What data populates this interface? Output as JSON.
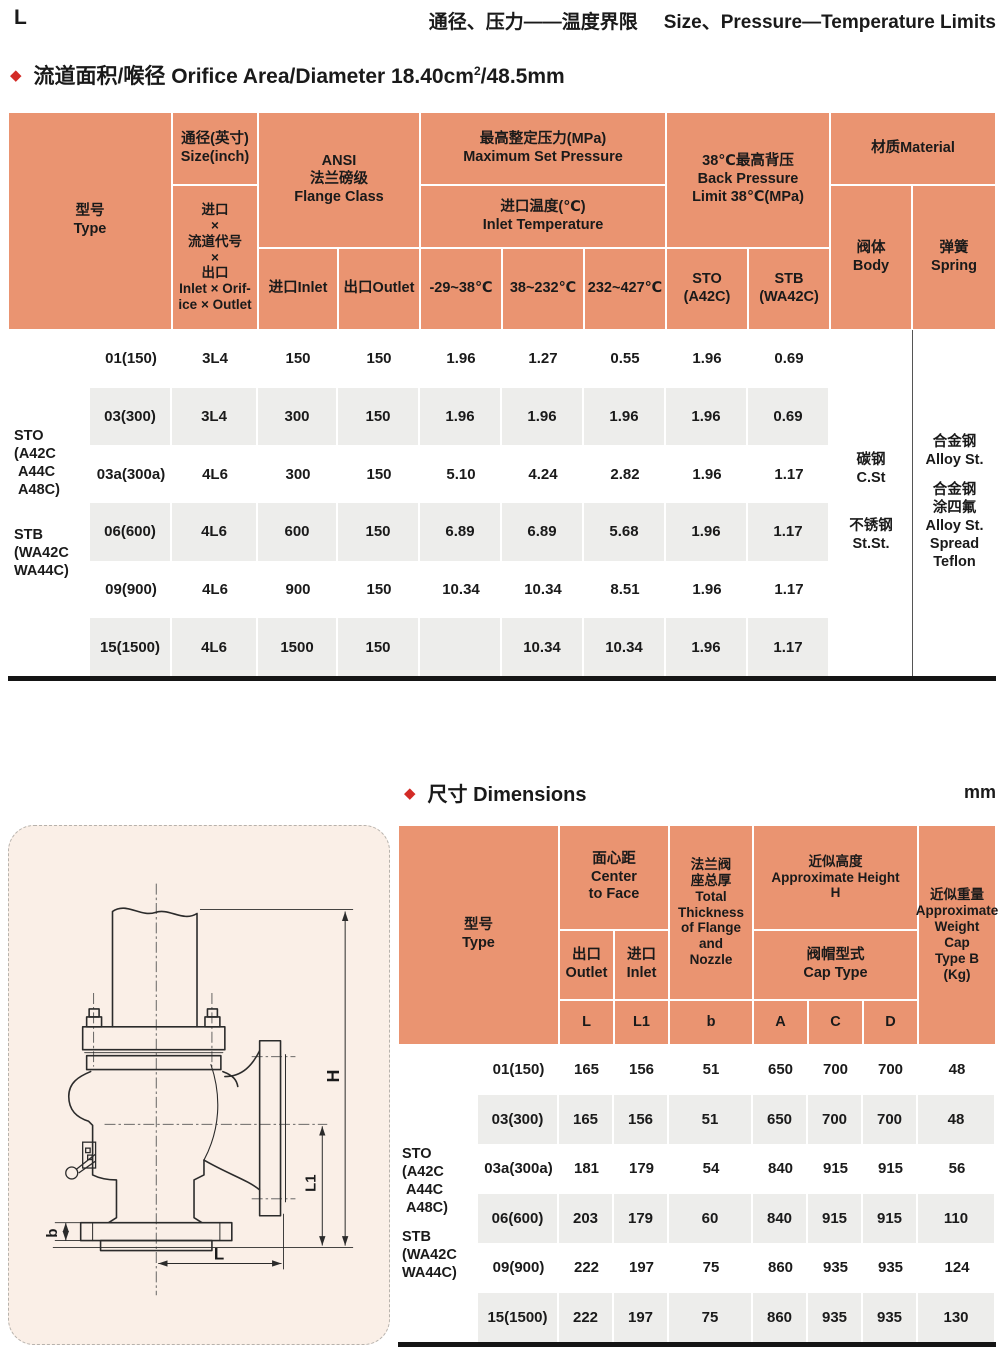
{
  "page": {
    "corner_letter": "L",
    "title_zh": "通径、压力——温度界限",
    "title_en": "Size、Pressure—Temperature Limits",
    "accent_red": "#d32b26",
    "header_orange": "#ea9471",
    "band_gray": "#ededeb"
  },
  "orifice": {
    "bullet": "◆",
    "text": "流道面积/喉径 Orifice Area/Diameter 18.40cm",
    "sup": "2",
    "suffix": "/48.5mm"
  },
  "pt_table": {
    "header": {
      "type": "型号\nType",
      "size": "通径(英寸)\nSize(inch)",
      "inlet_orifice_outlet": "进口\n×\n流道代号\n×\n出口\nInlet × Orif-\nice × Outlet",
      "ansi": "ANSI\n法兰磅级\nFlange Class",
      "inlet": "进口Inlet",
      "outlet": "出口Outlet",
      "max_set_pressure": "最高整定压力(MPa)\nMaximum Set Pressure",
      "inlet_temperature": "进口温度(℃)\nInlet Temperature",
      "temp1": "-29~38℃",
      "temp2": "38~232℃",
      "temp3": "232~427℃",
      "back_pressure": "38℃最高背压\nBack Pressure\nLimit 38℃(MPa)",
      "sto": "STO\n(A42C)",
      "stb": "STB\n(WA42C)",
      "material": "材质Material",
      "body": "阀体\nBody",
      "spring": "弹簧\nSpring"
    },
    "group_sto": "STO\n(A42C\n A44C\n A48C)",
    "group_stb": "STB\n(WA42C\nWA44C)",
    "body_carbon": "碳钢\nC.St",
    "body_stainless": "不锈钢\nSt.St.",
    "spring_alloy": "合金钢\nAlloy St.",
    "spring_teflon": "合金钢\n涂四氟\nAlloy St.\nSpread\nTeflon",
    "rows": [
      [
        "01(150)",
        "3L4",
        "150",
        "150",
        "1.96",
        "1.27",
        "0.55",
        "1.96",
        "0.69"
      ],
      [
        "03(300)",
        "3L4",
        "300",
        "150",
        "1.96",
        "1.96",
        "1.96",
        "1.96",
        "0.69"
      ],
      [
        "03a(300a)",
        "4L6",
        "300",
        "150",
        "5.10",
        "4.24",
        "2.82",
        "1.96",
        "1.17"
      ],
      [
        "06(600)",
        "4L6",
        "600",
        "150",
        "6.89",
        "6.89",
        "5.68",
        "1.96",
        "1.17"
      ],
      [
        "09(900)",
        "4L6",
        "900",
        "150",
        "10.34",
        "10.34",
        "8.51",
        "1.96",
        "1.17"
      ],
      [
        "15(1500)",
        "4L6",
        "1500",
        "150",
        "",
        "10.34",
        "10.34",
        "1.96",
        "1.17"
      ]
    ]
  },
  "dims": {
    "bullet": "◆",
    "title": "尺寸 Dimensions",
    "unit": "mm",
    "header": {
      "type": "型号\nType",
      "center_to_face": "面心距\nCenter\nto Face",
      "outlet": "出口\nOutlet",
      "inlet": "进口\nInlet",
      "thickness": "法兰阀\n座总厚\nTotal\nThickness\nof Flange\nand\nNozzle",
      "approx_height": "近似高度\nApproximate Height\nH",
      "cap_type": "阀帽型式\nCap Type",
      "weight": "近似重量\nApproximate\nWeight\nCap\nType B\n(Kg)"
    },
    "letters": [
      "L",
      "L1",
      "b",
      "A",
      "C",
      "D"
    ],
    "group_sto": "STO\n(A42C\n A44C\n A48C)",
    "group_stb": "STB\n(WA42C\nWA44C)",
    "rows": [
      [
        "01(150)",
        "165",
        "156",
        "51",
        "650",
        "700",
        "700",
        "48"
      ],
      [
        "03(300)",
        "165",
        "156",
        "51",
        "650",
        "700",
        "700",
        "48"
      ],
      [
        "03a(300a)",
        "181",
        "179",
        "54",
        "840",
        "915",
        "915",
        "56"
      ],
      [
        "06(600)",
        "203",
        "179",
        "60",
        "840",
        "915",
        "915",
        "110"
      ],
      [
        "09(900)",
        "222",
        "197",
        "75",
        "860",
        "935",
        "935",
        "124"
      ],
      [
        "15(1500)",
        "222",
        "197",
        "75",
        "860",
        "935",
        "935",
        "130"
      ]
    ]
  },
  "drawing": {
    "labels": {
      "h": "H",
      "l1": "L1",
      "b": "b",
      "l": "L"
    }
  }
}
